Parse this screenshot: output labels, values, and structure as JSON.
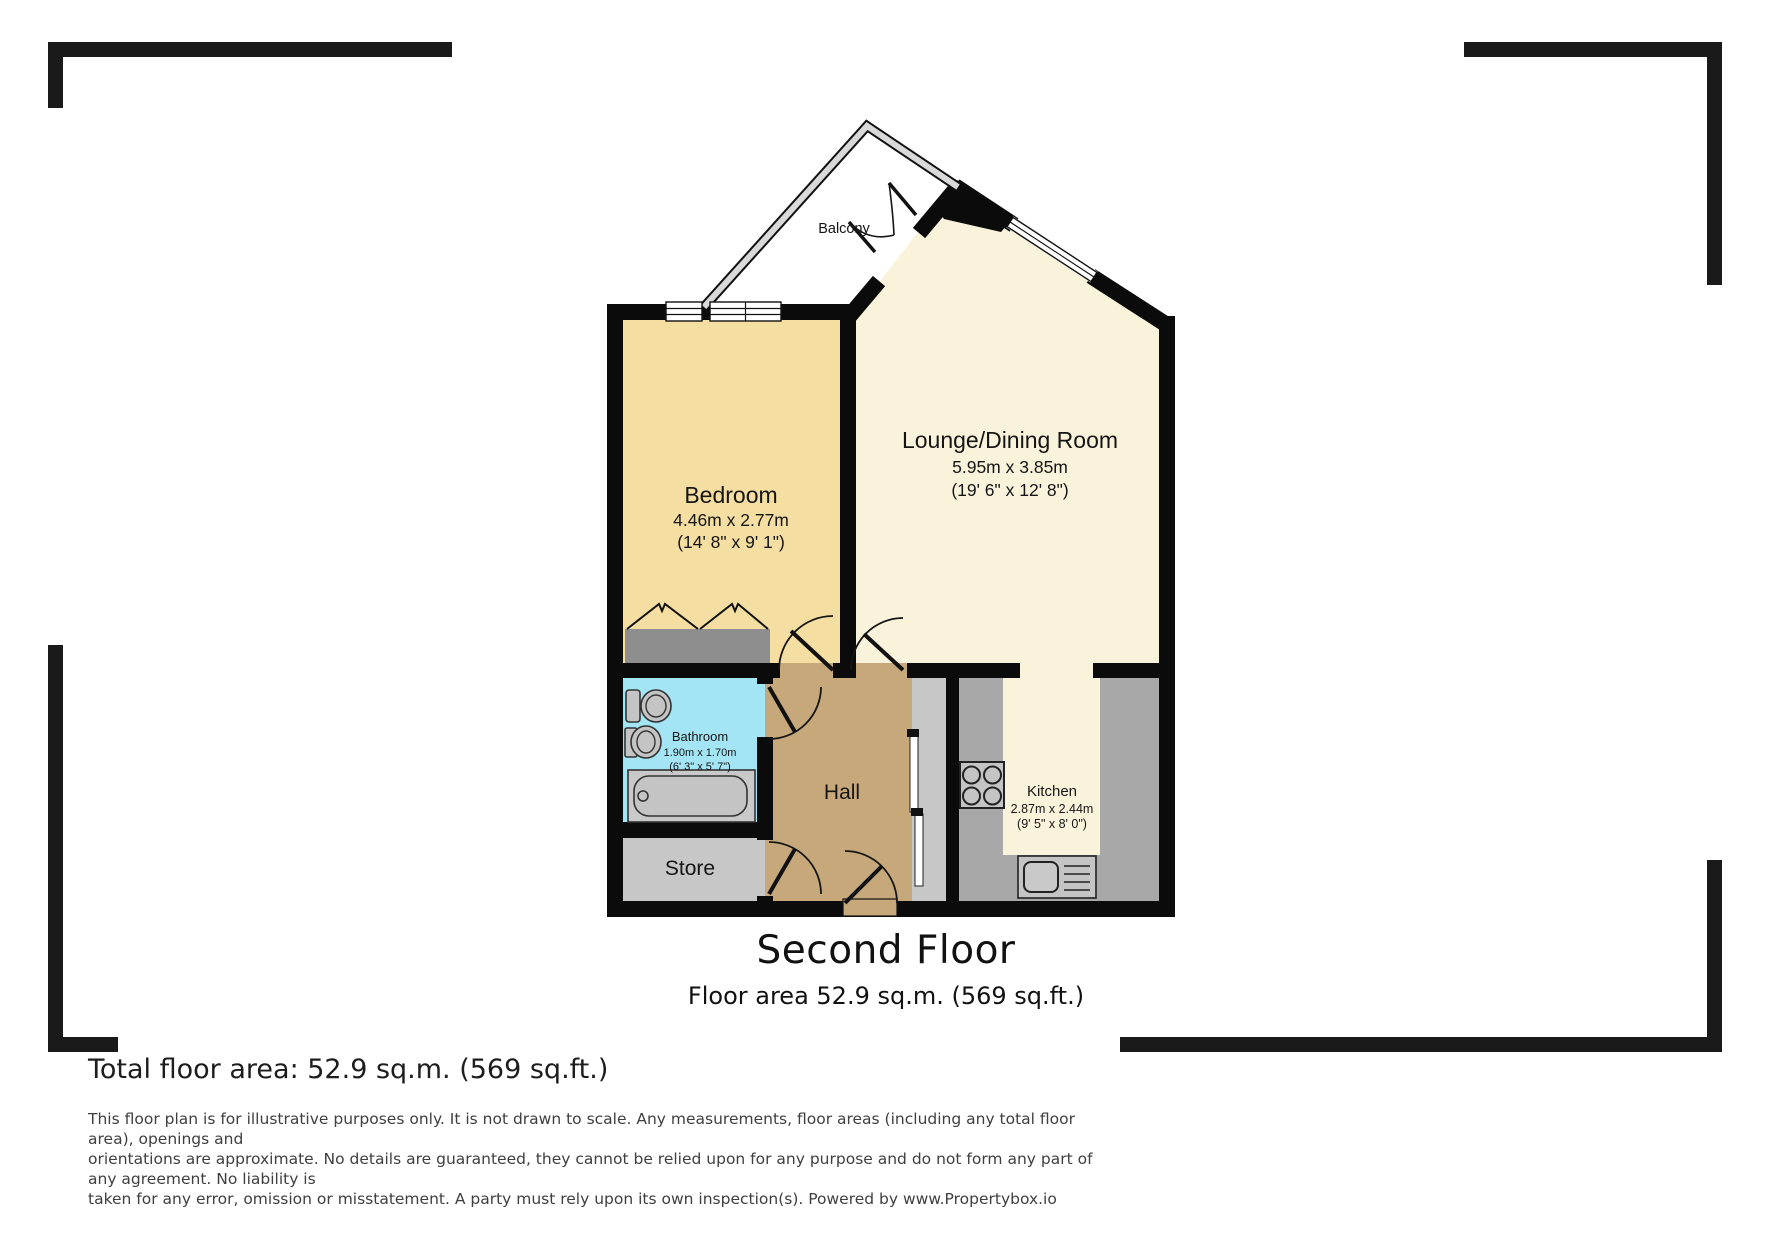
{
  "plan": {
    "titles": {
      "floor_title": "Second Floor",
      "floor_area": "Floor area 52.9 sq.m. (569 sq.ft.)"
    },
    "rooms": {
      "balcony": {
        "name": "Balcony"
      },
      "bedroom": {
        "name": "Bedroom",
        "dim_m": "4.46m x 2.77m",
        "dim_ft": "(14' 8\" x 9' 1\")"
      },
      "lounge": {
        "name": "Lounge/Dining Room",
        "dim_m": "5.95m x 3.85m",
        "dim_ft": "(19' 6\" x 12' 8\")"
      },
      "bathroom": {
        "name": "Bathroom",
        "dim_m": "1.90m x 1.70m",
        "dim_ft": "(6' 3\" x 5' 7\")"
      },
      "hall": {
        "name": "Hall"
      },
      "store": {
        "name": "Store"
      },
      "kitchen": {
        "name": "Kitchen",
        "dim_m": "2.87m x 2.44m",
        "dim_ft": "(9' 5\" x 8' 0\")"
      }
    },
    "colors": {
      "wall": "#0b0b0b",
      "bedroom": "#F5DEA1",
      "lounge": "#FAF3DB",
      "bathroom": "#A3E5F4",
      "hall": "#C7A87A",
      "store": "#C7C7C7",
      "strip": "#C7C7C7",
      "counter": "#A8A8A8",
      "wardrobe": "#8E8E8E",
      "fixture": "#C4C4C4"
    }
  },
  "footer": {
    "total_area": "Total floor area: 52.9 sq.m. (569 sq.ft.)",
    "disclaimer": "This floor plan is for illustrative purposes only. It is not drawn to scale. Any measurements, floor areas (including any total floor area), openings and\norientations are approximate. No details are guaranteed, they cannot be relied upon for any purpose and do not form any part of any agreement. No liability is\ntaken for any error, omission or misstatement. A party must rely upon its own inspection(s). Powered by www.Propertybox.io"
  }
}
